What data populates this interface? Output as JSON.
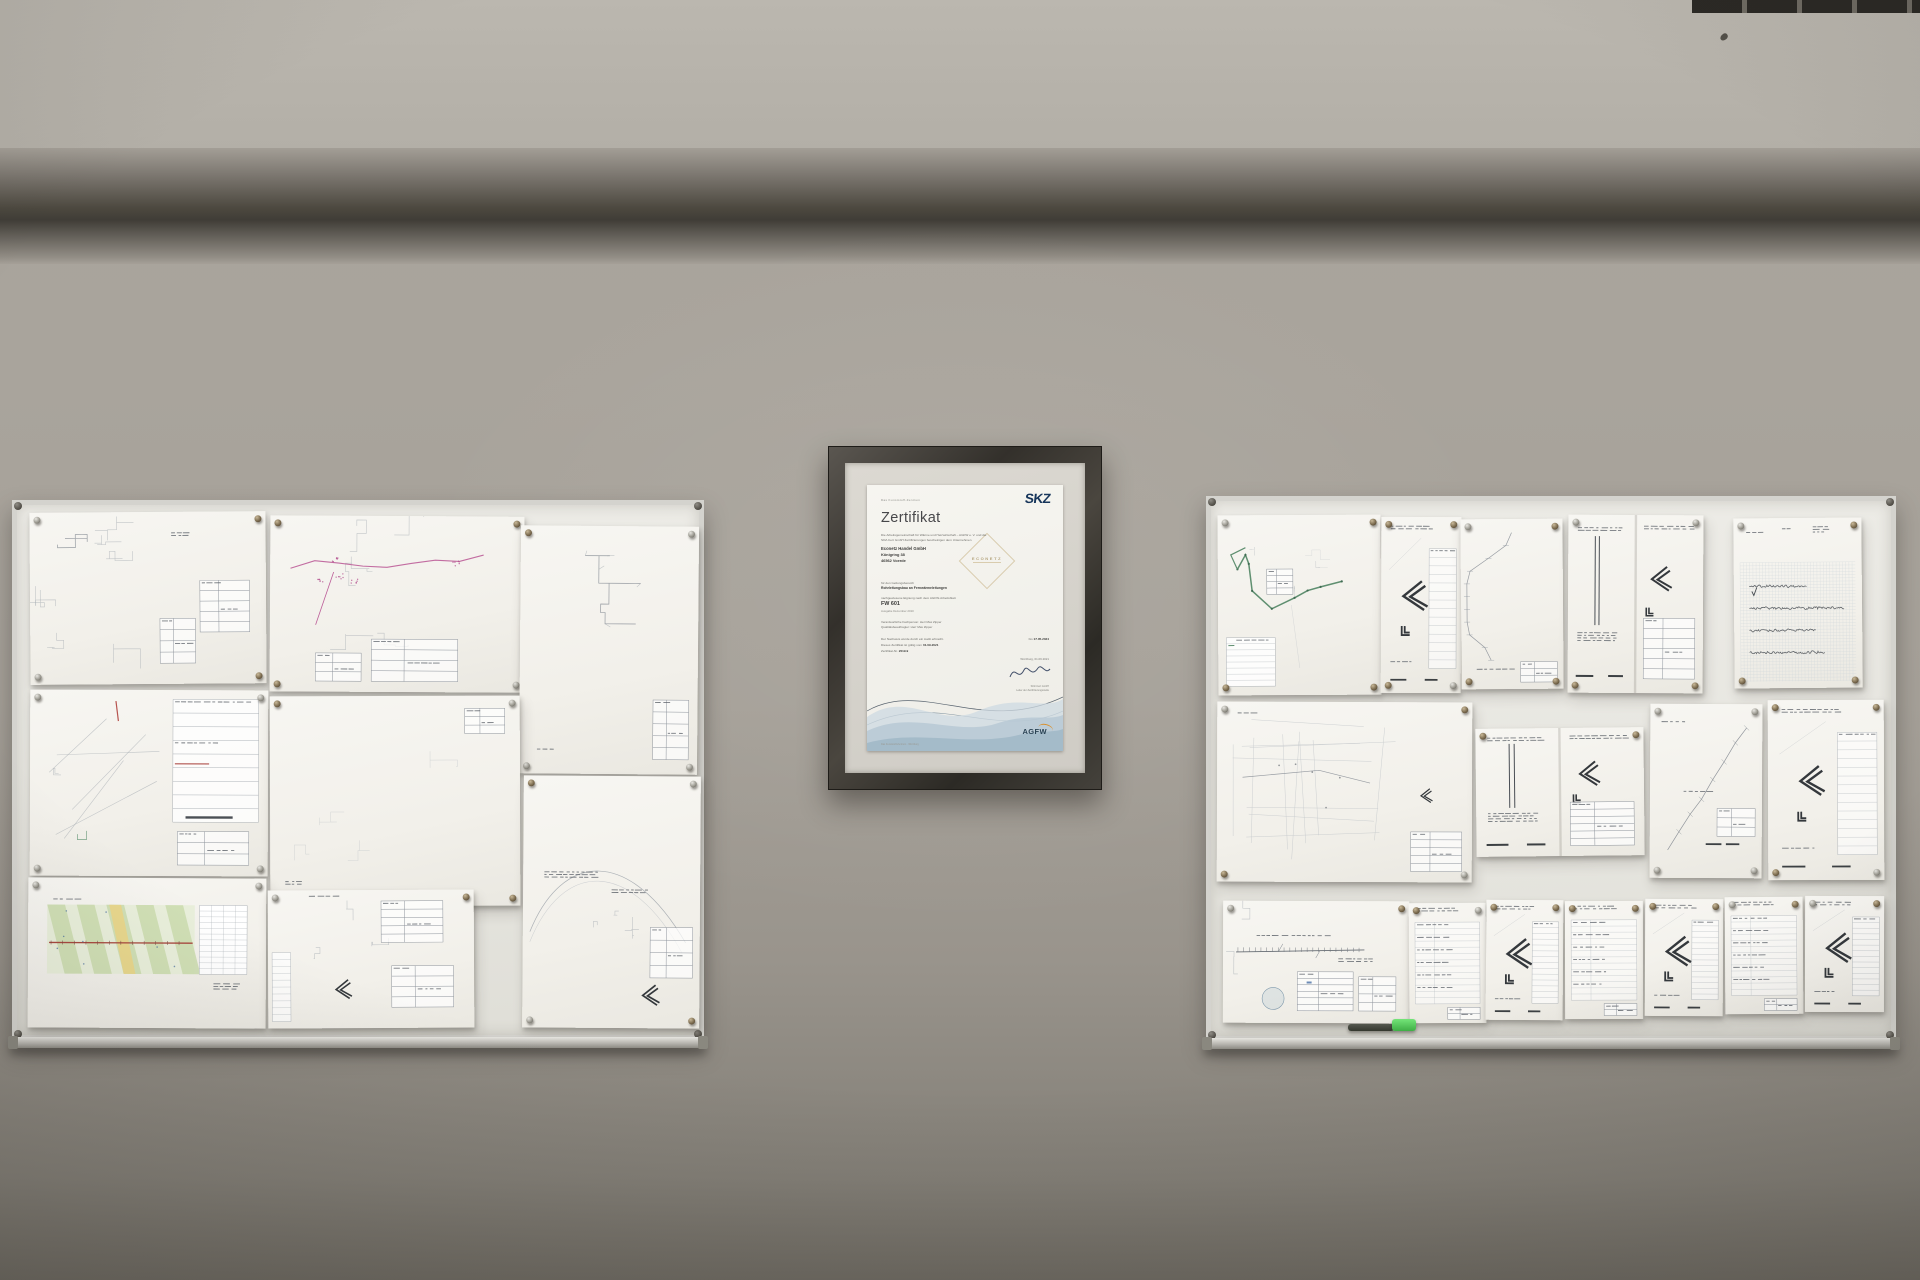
{
  "scene": {
    "description": "Office wall with two pinboards of technical district-heating pipeline drawings flanking a framed SKZ certificate",
    "wall_color": "#a6a198",
    "upper_wall_color": "#b7b3ab",
    "beam_shadow_color": "#44413b",
    "board_surface_color": "#e9e8e3",
    "board_frame_color": "#d4d3ce",
    "pin_color": "#7a6a4e",
    "marker_color": "#454843",
    "eraser_color": "#53cf5a"
  },
  "certificate": {
    "issuer_tagline": "Das Kunststoff-Zentrum",
    "issuer_logo": "SKZ",
    "title": "Zertifikat",
    "intro_line1": "Die Arbeitsgemeinschaft für Wärme und Heizwirtschaft – AGFW e. V. und die",
    "intro_line2": "SKZ-Cert GmbH Zertifizierungen bescheinigen dem Unternehmen",
    "company_name": "Econetz Handel GmbH",
    "company_street": "Königring 38",
    "company_city": "46562 Voerde",
    "watermark": "ECONETZ",
    "scope_label": "für den Geltungsbereich",
    "scope_text": "Rohrleitungsbau an Fernwärmeleitungen",
    "basis_label": "nachgewiesene Eignung nach dem AGFW-Arbeitsblatt",
    "standard": "FW 601",
    "standard_edition": "Ausgabe Dezember 2010",
    "contact_line1": "Verantwortliche Fachperson: Herr Max Zipper",
    "contact_line2": "Qualitätsbeauftragter: Herr Max Zipper",
    "audit_line": "Der Nachweis wurde durch ein Audit erbracht.",
    "valid_label": "Dieses Zertifikat ist gültig vom",
    "valid_from": "01.09.2021",
    "valid_to_label": "bis",
    "valid_to": "17.05.2024",
    "number_label": "Zertifikat-Nr.",
    "number": "2019.9",
    "place_date": "Würzburg, 01.09.2021",
    "signer_line1": "SKZ-Cert GmbH",
    "signer_line2": "Leiter der Zertifizierungsstelle",
    "agfw_logo": "AGFW",
    "footer": "Das Kunststoff-Zentrum · Würzburg"
  },
  "boards": {
    "left": {
      "x": 12,
      "y": 500,
      "w": 692,
      "h": 540,
      "sheets": [
        {
          "name": "site-plan-top-left",
          "kind": "plan-faint",
          "x": 18,
          "y": 12,
          "w": 236,
          "h": 172,
          "rot": -0.4,
          "seed": 1
        },
        {
          "name": "site-plan-pink-route",
          "kind": "plan-pink",
          "x": 258,
          "y": 16,
          "w": 254,
          "h": 176,
          "rot": 0.3,
          "seed": 2
        },
        {
          "name": "network-plan-tall",
          "kind": "network",
          "x": 508,
          "y": 26,
          "w": 178,
          "h": 248,
          "rot": 0.5,
          "seed": 3
        },
        {
          "name": "site-plan-legend",
          "kind": "plan-legend",
          "x": 18,
          "y": 190,
          "w": 238,
          "h": 186,
          "rot": 0.2,
          "seed": 4
        },
        {
          "name": "site-plan-blank",
          "kind": "plan-blank",
          "x": 258,
          "y": 196,
          "w": 250,
          "h": 210,
          "rot": -0.2,
          "seed": 5
        },
        {
          "name": "colored-route-map",
          "kind": "map-colored",
          "x": 16,
          "y": 378,
          "w": 238,
          "h": 150,
          "rot": 0.3,
          "seed": 6
        },
        {
          "name": "detail-sketch-sheet",
          "kind": "detail-sheet",
          "x": 256,
          "y": 390,
          "w": 206,
          "h": 138,
          "rot": -0.3,
          "seed": 7
        },
        {
          "name": "arc-plan-sheet",
          "kind": "arc-sheet",
          "x": 511,
          "y": 276,
          "w": 177,
          "h": 252,
          "rot": 0.4,
          "seed": 8
        }
      ]
    },
    "right": {
      "x": 1206,
      "y": 496,
      "w": 690,
      "h": 545,
      "sheets": [
        {
          "name": "green-route-plan",
          "kind": "route-green",
          "x": 12,
          "y": 19,
          "w": 163,
          "h": 180,
          "rot": -0.3,
          "seed": 11
        },
        {
          "name": "elbow-detail-1",
          "kind": "chevron-detail",
          "x": 175,
          "y": 21,
          "w": 80,
          "h": 176,
          "rot": 0.2,
          "seed": 12
        },
        {
          "name": "faint-route-portrait",
          "kind": "plan-faint-portrait",
          "x": 255,
          "y": 23,
          "w": 102,
          "h": 170,
          "rot": -0.4,
          "seed": 13
        },
        {
          "name": "booklet-elbow-detail",
          "kind": "booklet-chevron",
          "x": 362,
          "y": 19,
          "w": 135,
          "h": 178,
          "rot": 0.3,
          "seed": 14
        },
        {
          "name": "calc-notes-grid",
          "kind": "graph-notes",
          "x": 528,
          "y": 22,
          "w": 128,
          "h": 170,
          "rot": -0.5,
          "seed": 15
        },
        {
          "name": "city-grid-plan",
          "kind": "city-grid",
          "x": 11,
          "y": 206,
          "w": 255,
          "h": 180,
          "rot": 0.2,
          "seed": 16
        },
        {
          "name": "booklet-detail-2",
          "kind": "booklet-chevron",
          "x": 270,
          "y": 232,
          "w": 168,
          "h": 128,
          "rot": -0.6,
          "seed": 17
        },
        {
          "name": "diagonal-route-1",
          "kind": "route-diag",
          "x": 444,
          "y": 208,
          "w": 112,
          "h": 174,
          "rot": 0.3,
          "seed": 18
        },
        {
          "name": "diagonal-route-elbow",
          "kind": "chevron-detail",
          "x": 562,
          "y": 204,
          "w": 116,
          "h": 180,
          "rot": -0.2,
          "seed": 19
        },
        {
          "name": "pipeline-plan-long",
          "kind": "pipe-plan",
          "x": 17,
          "y": 405,
          "w": 186,
          "h": 122,
          "rot": 0.2,
          "seed": 20
        },
        {
          "name": "schedule-sheet-1",
          "kind": "table-sheet",
          "x": 203,
          "y": 407,
          "w": 77,
          "h": 120,
          "rot": -0.3,
          "seed": 21
        },
        {
          "name": "elbow-detail-2",
          "kind": "chevron-detail",
          "x": 280,
          "y": 404,
          "w": 77,
          "h": 120,
          "rot": 0.4,
          "seed": 22
        },
        {
          "name": "schedule-sheet-2",
          "kind": "table-sheet",
          "x": 359,
          "y": 405,
          "w": 78,
          "h": 118,
          "rot": -0.2,
          "seed": 23
        },
        {
          "name": "elbow-detail-3",
          "kind": "chevron-detail",
          "x": 439,
          "y": 403,
          "w": 78,
          "h": 117,
          "rot": 0.3,
          "seed": 24
        },
        {
          "name": "schedule-sheet-3",
          "kind": "table-sheet",
          "x": 519,
          "y": 401,
          "w": 78,
          "h": 117,
          "rot": -0.4,
          "seed": 25
        },
        {
          "name": "elbow-detail-4",
          "kind": "chevron-detail",
          "x": 599,
          "y": 400,
          "w": 79,
          "h": 116,
          "rot": 0.2,
          "seed": 26
        }
      ]
    }
  }
}
